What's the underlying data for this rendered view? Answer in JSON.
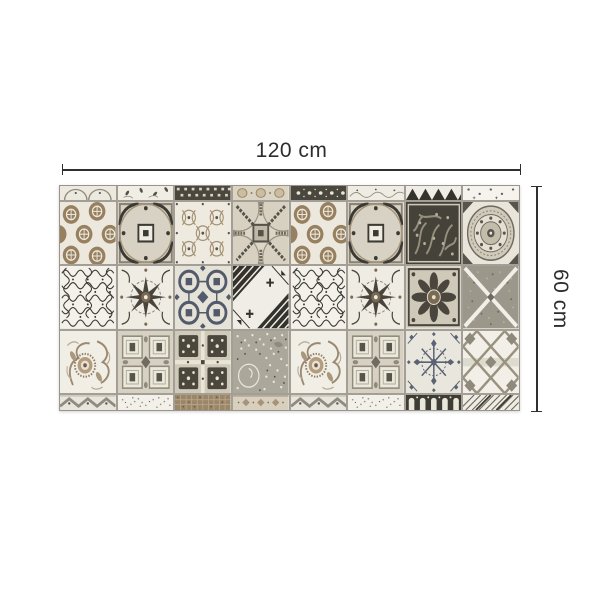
{
  "dimension_annotations": {
    "width_label": "120 cm",
    "height_label": "60 cm",
    "line_color": "#2f2f2f",
    "text_color": "#2d2d2d"
  },
  "rug": {
    "description": "patchwork vinyl rug of ornamental cement-tile patterns in cream, taupe, brown and charcoal, 8 columns by 3 full rows with partial rows cropped at top and bottom",
    "grout_color": "#a39f96",
    "palette": {
      "cream": "#ece8dd",
      "taupe_brown": "#97805f",
      "charcoal": "#45423a",
      "steel_blue": "#525a6b",
      "mid_grey": "#8f8a7c"
    },
    "top_strip": [
      "arc-light",
      "leaf-light",
      "checker-dark",
      "circle-beige",
      "dotband-dark",
      "damask-light",
      "chevron-dark",
      "dot-white"
    ],
    "rows": [
      [
        "circles-brown",
        "medallion-square",
        "lattice-light",
        "compass-circle",
        "circles-brown",
        "medallion-square",
        "damask-dark",
        "plate-medallion"
      ],
      [
        "filigree-dense",
        "rosette-star",
        "rings-steel",
        "geo-diagonal",
        "filigree-dense",
        "rosette-star",
        "flower-dark",
        "cross-grey"
      ],
      [
        "baroque-swirl",
        "coffer-grid",
        "checker-floral",
        "millefleur-grey",
        "baroque-swirl",
        "coffer-grid",
        "snowflake-steel",
        "trellis-moroccan"
      ]
    ],
    "bottom_strip": [
      "zigzag-grey",
      "speckle-white",
      "mosaic-brown",
      "ornament-beige",
      "zigzag-grey",
      "speckle-white",
      "crenel-dark",
      "stripes-diagonal"
    ]
  }
}
